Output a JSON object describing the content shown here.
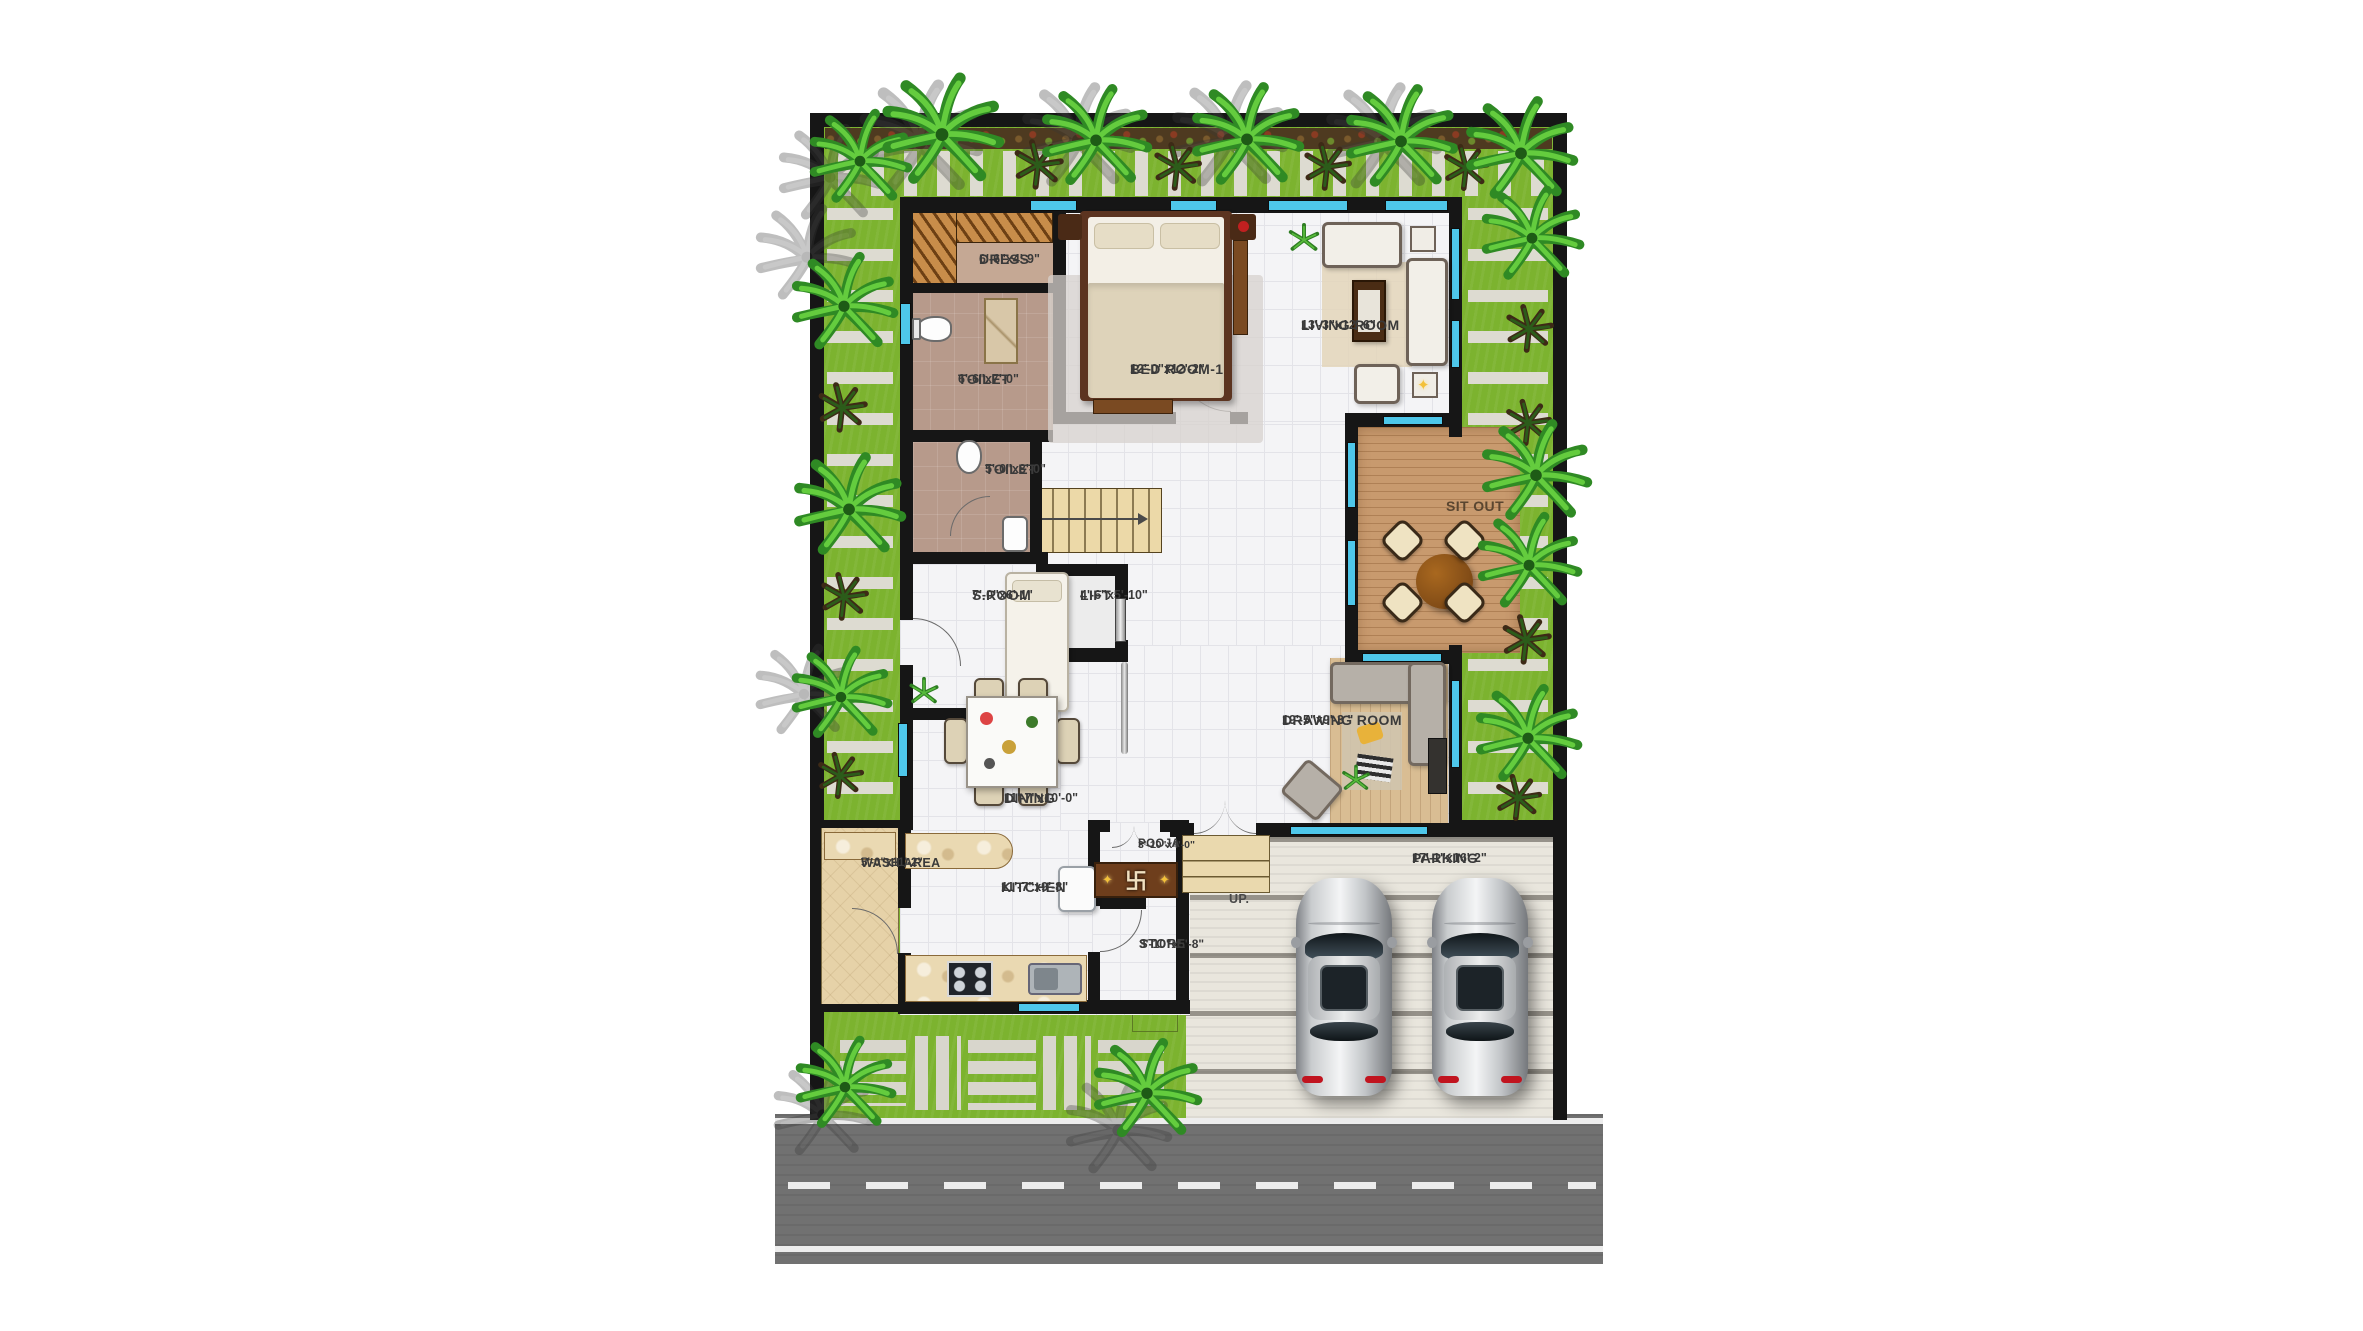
{
  "rooms": {
    "dress": {
      "name": "DRESS",
      "dims": "6'-6\"x4'-9\""
    },
    "toilet1": {
      "name": "TOILET",
      "dims": "6'-6\"x7'-0\""
    },
    "toilet2": {
      "name": "TOILET",
      "dims": "5'-0\"x8'-0\""
    },
    "bedroom1": {
      "name": "BED ROOM-1",
      "dims": "12'-0\"x12'-2\""
    },
    "living": {
      "name": "LIVING ROOM",
      "dims": "13'-3\"x12'-6\""
    },
    "sitout": {
      "name": "SIT OUT",
      "dims": ""
    },
    "sroom": {
      "name": "S.ROOM",
      "dims": "7'-0\"x6'-1\""
    },
    "lift": {
      "name": "LIFT",
      "dims": "4'-6\"x5'-10\""
    },
    "drawing": {
      "name": "DRAWING ROOM",
      "dims": "19'-5\"x9'-3 \""
    },
    "dining": {
      "name": "DINING",
      "dims": "11'-7\"x10'-0\""
    },
    "wash": {
      "name": "WASH AREA",
      "dims": "5'-0\"x11'-2\""
    },
    "kitchen": {
      "name": "KITCHEN",
      "dims": "11'-7\"x9'-8\""
    },
    "pooja": {
      "name": "POOJA",
      "dims": "3'-10\"x4'-0\""
    },
    "store": {
      "name": "STORE",
      "dims": "3'-10\"x5'-8\""
    },
    "parking": {
      "name": "PARKING",
      "dims": "17'-1\"x16'-2\""
    }
  },
  "labels": {
    "up": "UP.",
    "pooja_symbol": "卐",
    "sparkle": "✦"
  },
  "colors": {
    "grass": "#7cb32f",
    "wall": "#161616",
    "window_glass": "#4ec7ea",
    "wood_deck": "#c89a6e",
    "road": "#717171",
    "concrete": "#e9e6dd",
    "shrine_brown": "#6e3e1c",
    "gold": "#f3c13a"
  }
}
